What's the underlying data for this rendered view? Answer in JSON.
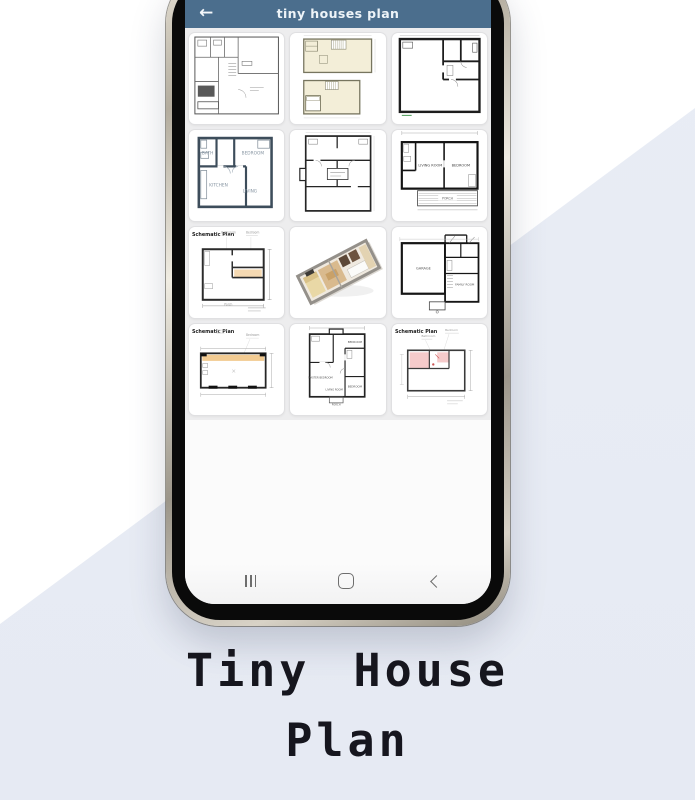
{
  "colors": {
    "appbar": "#4b6e8d",
    "background_accent": "#e9edf5",
    "caption_text": "#16161e",
    "schematic_orange": "#f2cb92",
    "schematic_pink": "#f5caca",
    "plan_yellow": "#f3eed8",
    "slate_walls": "#3d4d5b"
  },
  "phone": {
    "appbar": {
      "title": "tiny houses plan",
      "back_icon": "←"
    },
    "grid": {
      "cells": [
        {
          "id": "floorplan-bw-dense",
          "variant": "bwDense",
          "labels": []
        },
        {
          "id": "floorplan-two-story",
          "variant": "twoStoryYellow",
          "labels": []
        },
        {
          "id": "floorplan-bw-thick",
          "variant": "bwThick",
          "labels": []
        },
        {
          "id": "floorplan-labeled",
          "variant": "labeledSlate",
          "labels": [
            "BATH",
            "BEDROOM",
            "KITCHEN",
            "LIVING"
          ]
        },
        {
          "id": "floorplan-symmetric",
          "variant": "bwSymmetric",
          "labels": []
        },
        {
          "id": "floorplan-porch",
          "variant": "porchPlan",
          "labels": [
            "LIVING ROOM",
            "BEDROOM",
            "PORCH"
          ]
        },
        {
          "id": "floorplan-schematic-a",
          "variant": "schematicA",
          "title": "Schematic Plan",
          "labels": [
            "Bedroom",
            "Bathroom",
            "Porch"
          ]
        },
        {
          "id": "floorplan-3d-iso",
          "variant": "iso3d",
          "labels": []
        },
        {
          "id": "floorplan-garage",
          "variant": "garagePlan",
          "labels": [
            "GARAGE",
            "FAMILY ROOM"
          ]
        },
        {
          "id": "floorplan-schematic-b",
          "variant": "schematicB",
          "title": "Schematic Plan",
          "labels": [
            "Bedroom"
          ]
        },
        {
          "id": "floorplan-multi-room",
          "variant": "bwMulti",
          "labels": [
            "BEDROOM",
            "MASTER BEDROOM",
            "LIVING ROOM",
            "BEDROOM",
            "PORCH"
          ]
        },
        {
          "id": "floorplan-schematic-pink",
          "variant": "schematicPink",
          "title": "Schematic Plan",
          "labels": [
            "Bedroom",
            "Bathroom"
          ]
        }
      ]
    },
    "navbar": {
      "recents_icon": "|||",
      "home_icon": "rounded-square",
      "back_icon": "<"
    }
  },
  "caption": {
    "line1": "Tiny House",
    "line2": "Plan"
  }
}
